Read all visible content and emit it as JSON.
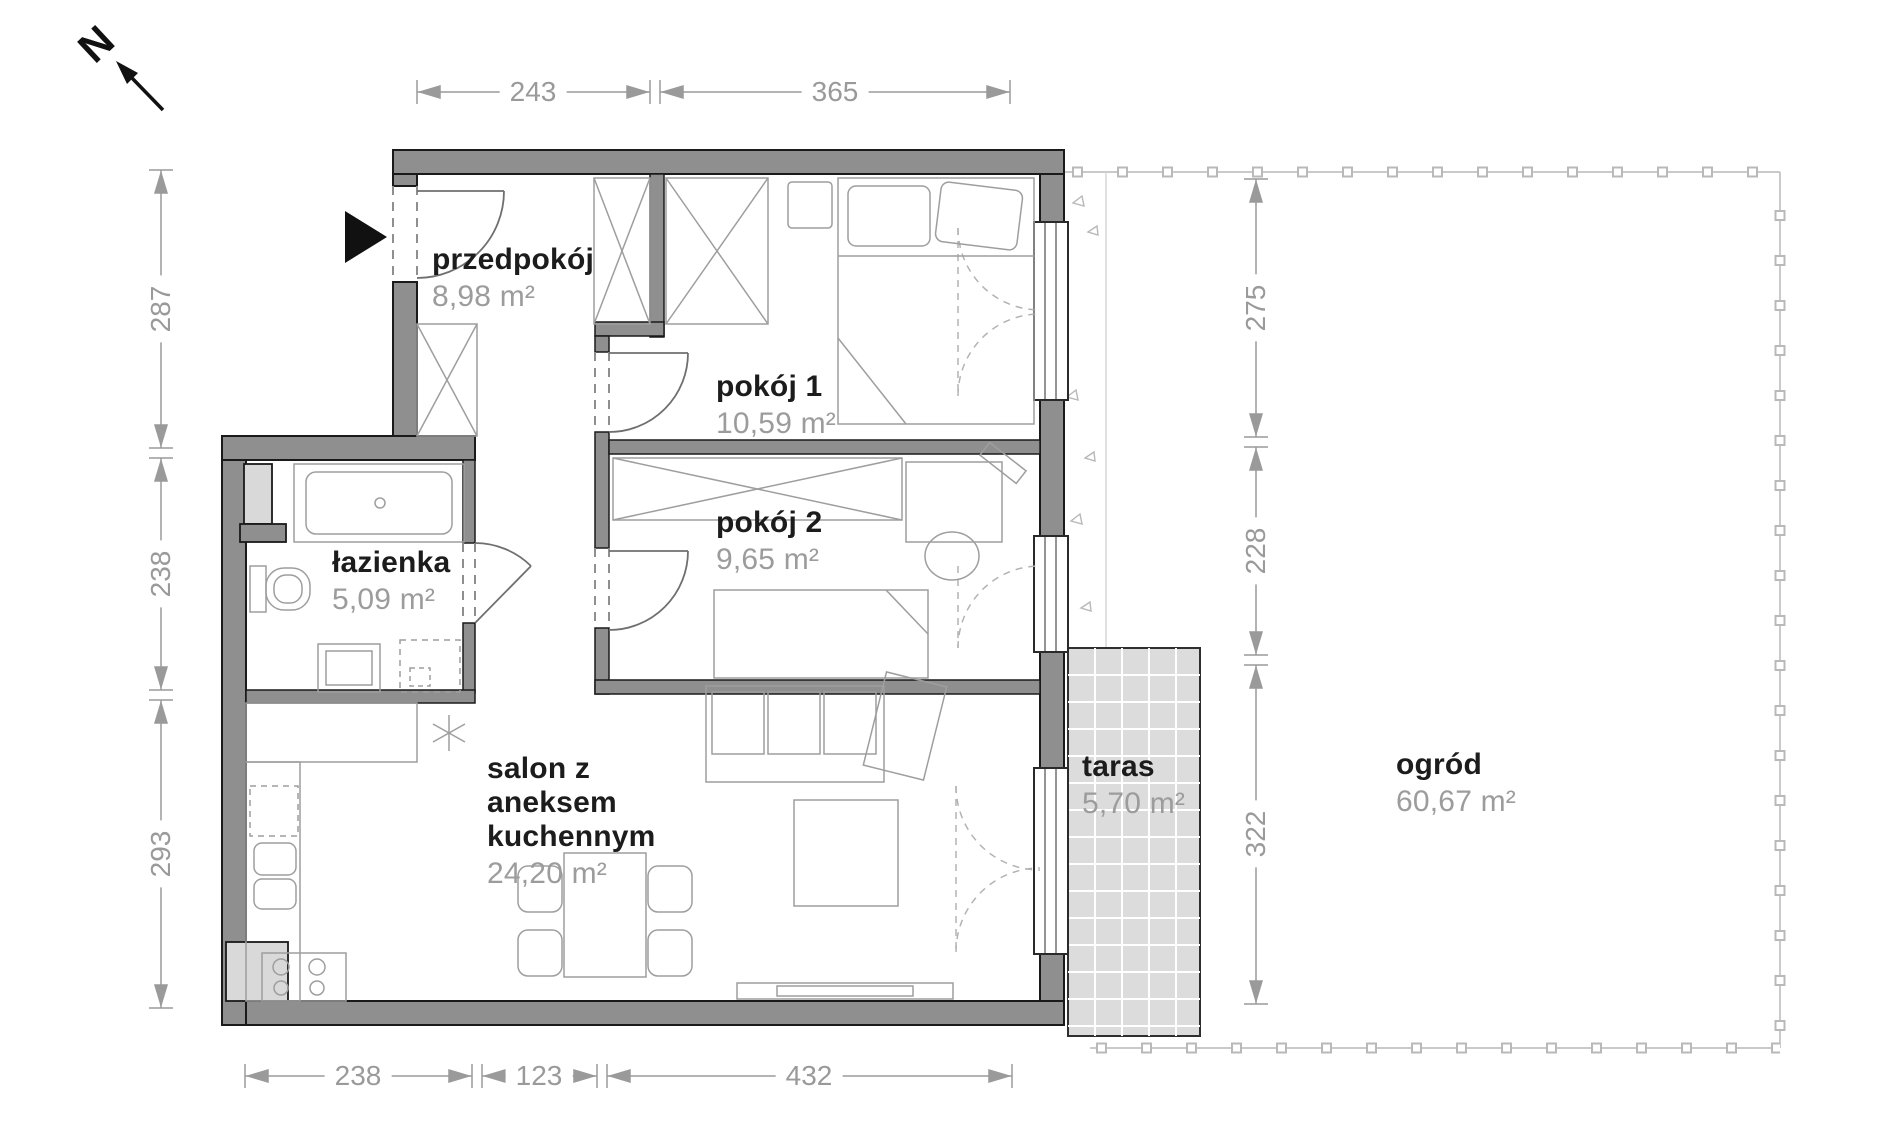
{
  "plan": {
    "north_label": "N",
    "rooms": [
      {
        "name": "przedpokój",
        "area": "8,98 m²"
      },
      {
        "name": "pokój 1",
        "area": "10,59 m²"
      },
      {
        "name": "pokój 2",
        "area": "9,65 m²"
      },
      {
        "name": "łazienka",
        "area": "5,09 m²"
      },
      {
        "name": "salon z aneksem kuchennym",
        "area": "24,20 m²"
      },
      {
        "name": "taras",
        "area": "5,70 m²"
      },
      {
        "name": "ogród",
        "area": "60,67 m²"
      }
    ],
    "dimensions_cm": {
      "top": [
        "243",
        "365"
      ],
      "bottom": [
        "238",
        "123",
        "432"
      ],
      "left": [
        "287",
        "238",
        "293"
      ],
      "garden_right": [
        "275",
        "228",
        "322"
      ]
    },
    "colors": {
      "wall": "#8f8f8f",
      "line_dark": "#1a1a1a",
      "dim_gray": "#9a9a9a",
      "terrace_fill": "#dcdcdc"
    }
  }
}
